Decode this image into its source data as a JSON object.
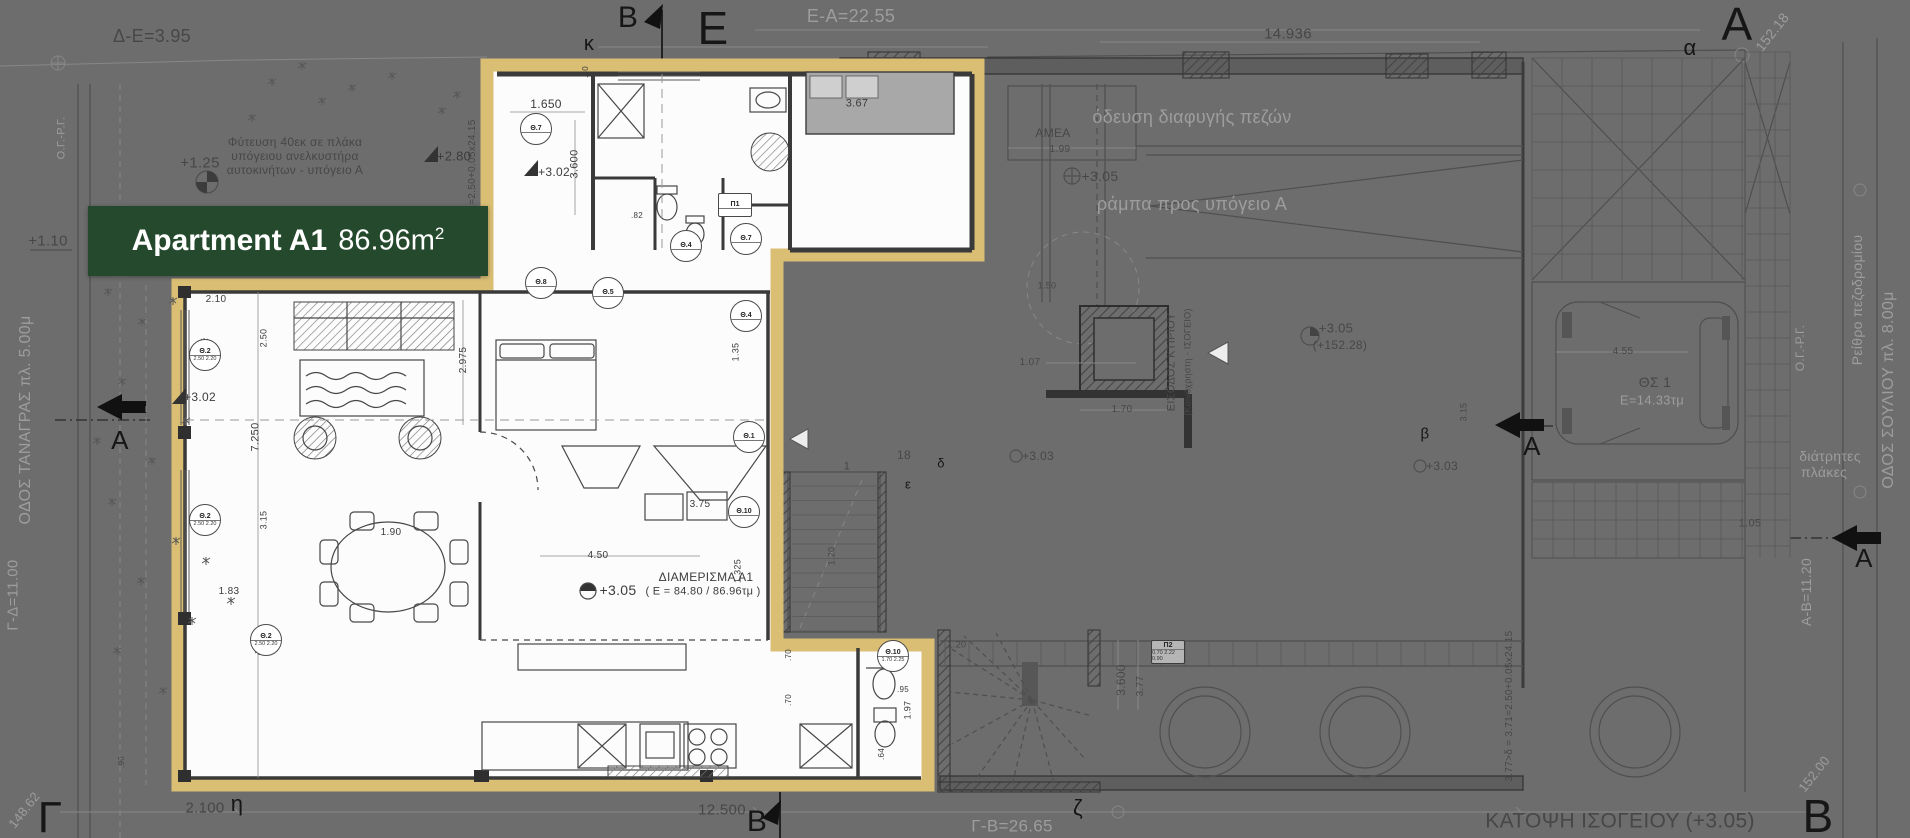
{
  "colors": {
    "background": "#6d6d6d",
    "highlight_border": "#d9be74",
    "label_background": "#25492d",
    "label_text": "#ffffff"
  },
  "label": {
    "apartment_name": "Apartment A1",
    "area_value": "86.96m",
    "area_superscript": "2"
  },
  "annotations": [
    {
      "n": "big-letter-epsilon",
      "t": "Ε",
      "x": 713,
      "y": 28,
      "s": 46,
      "c": "ink"
    },
    {
      "n": "big-letter-alpha-top",
      "t": "Α",
      "x": 1737,
      "y": 24,
      "s": 46,
      "c": "ink"
    },
    {
      "n": "big-letter-gamma",
      "t": "Γ",
      "x": 50,
      "y": 818,
      "s": 44,
      "c": "ink"
    },
    {
      "n": "big-letter-beta-bottom",
      "t": "Β",
      "x": 1818,
      "y": 816,
      "s": 46,
      "c": "ink"
    },
    {
      "n": "section-mark-b-top",
      "t": "Β",
      "x": 628,
      "y": 18,
      "s": 30,
      "c": "ink"
    },
    {
      "n": "section-mark-b-bottom",
      "t": "Β",
      "x": 757,
      "y": 822,
      "s": 30,
      "c": "ink"
    },
    {
      "n": "section-label-a-left",
      "t": "Α",
      "x": 120,
      "y": 440,
      "s": 26,
      "c": "ink"
    },
    {
      "n": "section-label-a-mid-right",
      "t": "Α",
      "x": 1532,
      "y": 446,
      "s": 26,
      "c": "ink"
    },
    {
      "n": "section-label-a-right",
      "t": "Α",
      "x": 1864,
      "y": 558,
      "s": 26,
      "c": "ink"
    },
    {
      "n": "grid-letter-kappa",
      "t": "κ",
      "x": 589,
      "y": 44,
      "s": 20,
      "c": "ink"
    },
    {
      "n": "grid-letter-alpha",
      "t": "α",
      "x": 1690,
      "y": 48,
      "s": 22,
      "c": "ink"
    },
    {
      "n": "grid-letter-eta",
      "t": "η",
      "x": 237,
      "y": 804,
      "s": 22,
      "c": "ink"
    },
    {
      "n": "grid-letter-zeta",
      "t": "ζ",
      "x": 1078,
      "y": 808,
      "s": 22,
      "c": "ink"
    },
    {
      "n": "grid-letter-delta",
      "t": "δ",
      "x": 941,
      "y": 463,
      "s": 13,
      "c": "ink"
    },
    {
      "n": "grid-letter-epsilon-small",
      "t": "ε",
      "x": 908,
      "y": 484,
      "s": 13,
      "c": "ink"
    },
    {
      "n": "grid-letter-beta-small",
      "t": "β",
      "x": 1425,
      "y": 434,
      "s": 15,
      "c": "ink"
    },
    {
      "n": "dim-e-a",
      "t": "Ε-Α=22.55",
      "x": 851,
      "y": 16,
      "s": 18,
      "c": "dim"
    },
    {
      "n": "escape-route-label",
      "t": "όδευση διαφυγής πεζών",
      "x": 1192,
      "y": 117,
      "s": 18,
      "c": "dim"
    },
    {
      "n": "ramp-label",
      "t": "ράμπα προς υπόγειο Α",
      "x": 1192,
      "y": 204,
      "s": 18,
      "c": "dim"
    },
    {
      "n": "curb-label",
      "t": "Ρείθρο πεζοδρομίου",
      "x": 1857,
      "y": 300,
      "s": 14,
      "c": "dim",
      "r": -90
    },
    {
      "n": "street-souliou",
      "t": "ΟΔΟΣ ΣΟΥΛΙΟΥ πλ. 8.00μ",
      "x": 1889,
      "y": 390,
      "s": 16,
      "c": "dim",
      "r": -90
    },
    {
      "n": "og-rg-right",
      "t": "Ο.Γ.-Ρ.Γ.",
      "x": 1800,
      "y": 348,
      "s": 12,
      "c": "dim",
      "r": -90
    },
    {
      "n": "og-rg-left",
      "t": "Ο.Γ.-Ρ.Γ.",
      "x": 62,
      "y": 138,
      "s": 11,
      "c": "dim",
      "r": -90
    },
    {
      "n": "perforated-slabs-1",
      "t": "διάτρητες",
      "x": 1830,
      "y": 456,
      "s": 14,
      "c": "dim"
    },
    {
      "n": "perforated-slabs-2",
      "t": "πλάκες",
      "x": 1824,
      "y": 472,
      "s": 14,
      "c": "dim"
    },
    {
      "n": "dim-g-b",
      "t": "Γ-Β=26.65",
      "x": 1012,
      "y": 826,
      "s": 17,
      "c": "dim"
    },
    {
      "n": "elev-152-18",
      "t": "152.18",
      "x": 1772,
      "y": 32,
      "s": 14,
      "c": "dim",
      "r": -52
    },
    {
      "n": "elev-152-00",
      "t": "152.00",
      "x": 1814,
      "y": 774,
      "s": 13,
      "c": "dim",
      "r": -52
    },
    {
      "n": "elev-148-62",
      "t": "148.62",
      "x": 24,
      "y": 810,
      "s": 13,
      "c": "dim",
      "r": -52
    },
    {
      "n": "dim-a-b",
      "t": "Α-Β=11.20",
      "x": 1806,
      "y": 592,
      "s": 14,
      "c": "dim",
      "r": -90
    },
    {
      "n": "dim-g-d",
      "t": "Γ-Δ=11.00",
      "x": 13,
      "y": 595,
      "s": 15,
      "c": "dim",
      "r": -90
    },
    {
      "n": "street-tanagras",
      "t": "ΟΔΟΣ ΤΑΝΑΓΡΑΣ πλ. 5.00μ",
      "x": 26,
      "y": 420,
      "s": 16,
      "c": "dim",
      "r": -90
    },
    {
      "n": "parking-area",
      "t": "Ε=14.33τμ",
      "x": 1652,
      "y": 400,
      "s": 13,
      "c": "dim"
    },
    {
      "n": "dim-d-e",
      "t": "Δ-Ε=3.95",
      "x": 152,
      "y": 36,
      "s": 18,
      "c": "dimd"
    },
    {
      "n": "dim-14-936",
      "t": "14.936",
      "x": 1288,
      "y": 34,
      "s": 15,
      "c": "dimd"
    },
    {
      "n": "dim-2-100",
      "t": "2.100",
      "x": 205,
      "y": 808,
      "s": 15,
      "c": "dimd"
    },
    {
      "n": "dim-12-500",
      "t": "12.500",
      "x": 722,
      "y": 810,
      "s": 15,
      "c": "dimd"
    },
    {
      "n": "floor-title",
      "t": "ΚΑΤΟΨΗ  ΙΣΟΓΕΙΟΥ (+3.05)",
      "x": 1620,
      "y": 821,
      "s": 21,
      "c": "dimd"
    },
    {
      "n": "amea-label",
      "t": "ΑΜΕΑ",
      "x": 1053,
      "y": 133,
      "s": 12,
      "c": "dimd"
    },
    {
      "n": "dim-1-99",
      "t": "1.99",
      "x": 1060,
      "y": 150,
      "s": 10,
      "c": "dimd"
    },
    {
      "n": "level-3-05-a",
      "t": "+3.05",
      "x": 1100,
      "y": 176,
      "s": 14,
      "c": "dimd"
    },
    {
      "n": "level-3-05-b",
      "t": "+3.05",
      "x": 1336,
      "y": 328,
      "s": 13,
      "c": "dimd"
    },
    {
      "n": "level-152-28",
      "t": "(+152.28)",
      "x": 1340,
      "y": 345,
      "s": 12,
      "c": "dimd"
    },
    {
      "n": "level-3-03-a",
      "t": "+3.03",
      "x": 1038,
      "y": 456,
      "s": 12,
      "c": "dimd"
    },
    {
      "n": "level-3-03-b",
      "t": "+3.03",
      "x": 1442,
      "y": 466,
      "s": 12,
      "c": "dimd"
    },
    {
      "n": "entrance-label-1",
      "t": "ΕΙΣΟΔΟΣ  ΚΤΙΡΙΟΥ",
      "x": 1172,
      "y": 362,
      "s": 11,
      "c": "dimd",
      "r": -90
    },
    {
      "n": "entrance-label-2",
      "t": "(Κοινόχρηστη - ΙΣΟΓΕΙΟ)",
      "x": 1188,
      "y": 362,
      "s": 9,
      "c": "dimd",
      "r": -90
    },
    {
      "n": "parking-spot",
      "t": "ΘΣ 1",
      "x": 1655,
      "y": 382,
      "s": 14,
      "c": "dimd"
    },
    {
      "n": "dim-4-55",
      "t": "4.55",
      "x": 1623,
      "y": 352,
      "s": 10,
      "c": "dimd"
    },
    {
      "n": "dim-3-15-car",
      "t": "3.15",
      "x": 1464,
      "y": 412,
      "s": 9,
      "c": "dimd",
      "r": -90
    },
    {
      "n": "dim-1-70",
      "t": "1.70",
      "x": 1122,
      "y": 410,
      "s": 10,
      "c": "dimd"
    },
    {
      "n": "dim-1-07",
      "t": "1.07",
      "x": 1030,
      "y": 363,
      "s": 10,
      "c": "dimd"
    },
    {
      "n": "planting-note-1",
      "t": "Φύτευση 40εκ σε πλάκα",
      "x": 295,
      "y": 142,
      "s": 12,
      "c": "dimd"
    },
    {
      "n": "planting-note-2",
      "t": "υπόγειου ανελκυστήρα",
      "x": 295,
      "y": 156,
      "s": 12,
      "c": "dimd"
    },
    {
      "n": "planting-note-3",
      "t": "αυτοκινήτων - υπόγειο Α",
      "x": 295,
      "y": 170,
      "s": 12,
      "c": "dimd"
    },
    {
      "n": "level-1-25",
      "t": "+1.25",
      "x": 200,
      "y": 163,
      "s": 15,
      "c": "dimd"
    },
    {
      "n": "level-1-10",
      "t": "+1.10",
      "x": 48,
      "y": 241,
      "s": 15,
      "c": "dimd"
    },
    {
      "n": "dim-3-600-stair",
      "t": "3.600",
      "x": 1121,
      "y": 680,
      "s": 12,
      "c": "dimd",
      "r": -90
    },
    {
      "n": "dim-3-77",
      "t": "3.77",
      "x": 1141,
      "y": 686,
      "s": 10,
      "c": "dimd",
      "r": -90
    },
    {
      "n": "dim-1-05",
      "t": "1.05",
      "x": 1750,
      "y": 524,
      "s": 11,
      "c": "dimd"
    },
    {
      "n": "slope-note-right",
      "t": "3.77>δ = 3.71=2.50+0.05x24.15",
      "x": 1510,
      "y": 706,
      "s": 10,
      "c": "dimd",
      "r": -90
    },
    {
      "n": "slope-note-top",
      "t": "δ1=2.50+0.05x24.15",
      "x": 473,
      "y": 168,
      "s": 10,
      "c": "dimd",
      "r": -90
    },
    {
      "n": "dim-1-20-a",
      "t": "1.20",
      "x": 957,
      "y": 645,
      "s": 9,
      "c": "dimd"
    },
    {
      "n": "dim-1-20-b",
      "t": "1.20",
      "x": 832,
      "y": 556,
      "s": 9,
      "c": "dimd",
      "r": -90
    },
    {
      "n": "radius-1-50",
      "t": "1.50",
      "x": 1047,
      "y": 286,
      "s": 9,
      "c": "dimd"
    },
    {
      "n": "stair-num-18",
      "t": "18",
      "x": 904,
      "y": 455,
      "s": 12,
      "c": "dimd"
    },
    {
      "n": "stair-num-1",
      "t": "1",
      "x": 847,
      "y": 467,
      "s": 11,
      "c": "dimd"
    },
    {
      "n": "dim-90",
      "t": ".90",
      "x": 122,
      "y": 762,
      "s": 8,
      "c": "dimd",
      "r": -90
    },
    {
      "n": "dim-1-650",
      "t": "1.650",
      "x": 546,
      "y": 104,
      "s": 12,
      "c": "apt"
    },
    {
      "n": "dim-3-600-apt",
      "t": "3.600",
      "x": 575,
      "y": 164,
      "s": 11,
      "c": "apt",
      "r": -90
    },
    {
      "n": "dim-3-67",
      "t": "3.67",
      "x": 857,
      "y": 104,
      "s": 11,
      "c": "apt"
    },
    {
      "n": "level-3-02-a",
      "t": "+3.02",
      "x": 554,
      "y": 172,
      "s": 12,
      "c": "apt"
    },
    {
      "n": "level-3-02-b",
      "t": "+3.02",
      "x": 200,
      "y": 397,
      "s": 12,
      "c": "apt"
    },
    {
      "n": "level-2-80",
      "t": "+2.80",
      "x": 454,
      "y": 156,
      "s": 13,
      "c": "apt"
    },
    {
      "n": "dim-2-10",
      "t": "2.10",
      "x": 216,
      "y": 300,
      "s": 10,
      "c": "apt"
    },
    {
      "n": "dim-2-50",
      "t": "2.50",
      "x": 264,
      "y": 338,
      "s": 9,
      "c": "apt",
      "r": -90
    },
    {
      "n": "dim-2-975",
      "t": "2.975",
      "x": 464,
      "y": 360,
      "s": 10,
      "c": "apt",
      "r": -90
    },
    {
      "n": "dim-7-250",
      "t": "7.250",
      "x": 256,
      "y": 437,
      "s": 11,
      "c": "apt",
      "r": -90
    },
    {
      "n": "dim-3-15-apt",
      "t": "3.15",
      "x": 264,
      "y": 520,
      "s": 9,
      "c": "apt",
      "r": -90
    },
    {
      "n": "dim-1-83",
      "t": "1.83",
      "x": 229,
      "y": 592,
      "s": 10,
      "c": "apt"
    },
    {
      "n": "dim-1-90",
      "t": "1.90",
      "x": 391,
      "y": 533,
      "s": 10,
      "c": "apt"
    },
    {
      "n": "dim-3-75",
      "t": "3.75",
      "x": 700,
      "y": 505,
      "s": 10,
      "c": "apt"
    },
    {
      "n": "dim-4-50",
      "t": "4.50",
      "x": 598,
      "y": 556,
      "s": 10,
      "c": "apt"
    },
    {
      "n": "dim-1-325",
      "t": "1.325",
      "x": 738,
      "y": 571,
      "s": 9,
      "c": "apt",
      "r": -90
    },
    {
      "n": "level-3-05-apt",
      "t": "+3.05",
      "x": 618,
      "y": 590,
      "s": 14,
      "c": "apt"
    },
    {
      "n": "apartment-id",
      "t": "ΔΙΑΜΕΡΙΣΜΑ Α1",
      "x": 706,
      "y": 577,
      "s": 12,
      "c": "apt"
    },
    {
      "n": "apartment-id-area",
      "t": "( Ε = 84.80 / 86.96τμ )",
      "x": 703,
      "y": 592,
      "s": 11,
      "c": "apt"
    },
    {
      "n": "dim-1-97",
      "t": "1.97",
      "x": 908,
      "y": 710,
      "s": 9,
      "c": "apt",
      "r": -90
    },
    {
      "n": "dim-95",
      "t": ".95",
      "x": 903,
      "y": 690,
      "s": 8,
      "c": "apt"
    },
    {
      "n": "dim-64",
      "t": ".64",
      "x": 882,
      "y": 754,
      "s": 8,
      "c": "apt",
      "r": -90
    },
    {
      "n": "dim-70-a",
      "t": ".70",
      "x": 789,
      "y": 655,
      "s": 8,
      "c": "apt",
      "r": -90
    },
    {
      "n": "dim-70-b",
      "t": ".70",
      "x": 789,
      "y": 700,
      "s": 8,
      "c": "apt",
      "r": -90
    },
    {
      "n": "dim-80",
      "t": ".80",
      "x": 586,
      "y": 72,
      "s": 8,
      "c": "apt",
      "r": -90
    },
    {
      "n": "dim-82",
      "t": ".82",
      "x": 637,
      "y": 216,
      "s": 8,
      "c": "apt"
    },
    {
      "n": "dim-1-35",
      "t": "1.35",
      "x": 736,
      "y": 352,
      "s": 9,
      "c": "apt",
      "r": -90
    }
  ],
  "door_symbols": [
    {
      "label": "Θ.7",
      "x": 536,
      "y": 129
    },
    {
      "label": "Θ.8",
      "x": 541,
      "y": 283
    },
    {
      "label": "Θ.5",
      "x": 608,
      "y": 293
    },
    {
      "label": "Θ.4",
      "x": 686,
      "y": 246
    },
    {
      "label": "Θ.7",
      "x": 746,
      "y": 239
    },
    {
      "label": "Θ.4",
      "x": 746,
      "y": 316
    },
    {
      "label": "Θ.1",
      "x": 749,
      "y": 437
    },
    {
      "label": "Θ.10",
      "x": 744,
      "y": 512
    },
    {
      "label": "Θ.2",
      "x": 205,
      "y": 355,
      "values": [
        "2.50",
        "2.20"
      ]
    },
    {
      "label": "Θ.2",
      "x": 205,
      "y": 520,
      "values": [
        "2.50",
        "2.20"
      ]
    },
    {
      "label": "Θ.2",
      "x": 266,
      "y": 640,
      "values": [
        "2.50",
        "2.20"
      ]
    },
    {
      "label": "Θ.10",
      "x": 893,
      "y": 656,
      "values": [
        "1.70",
        "2.25"
      ]
    },
    {
      "label": "Π1",
      "x": 735,
      "y": 205,
      "shape": "box"
    },
    {
      "label": "Π2",
      "x": 1168,
      "y": 652,
      "shape": "box",
      "zone": "dim",
      "values": [
        "0.70",
        "2.22",
        "0.90"
      ]
    }
  ]
}
